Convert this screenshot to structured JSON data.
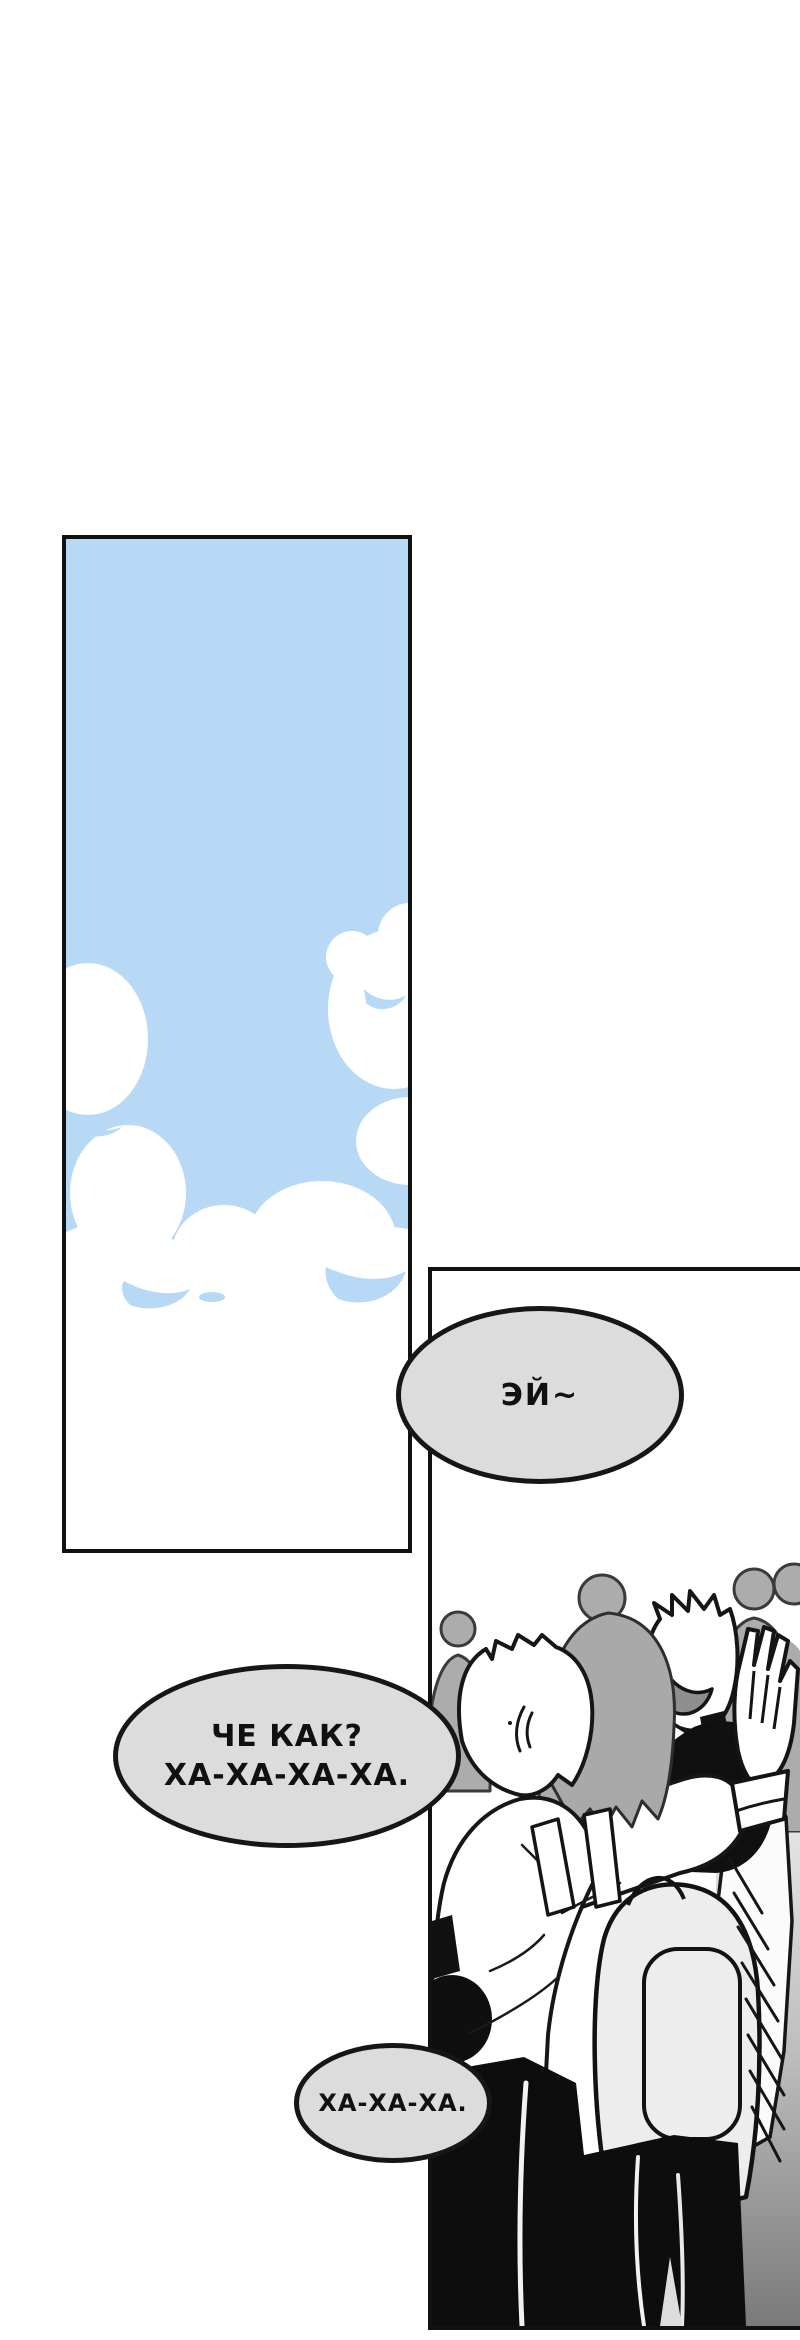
{
  "page": {
    "kind": "webtoon comic page",
    "language": "ru",
    "background": "#FFFFFF"
  },
  "colors": {
    "panel_border": "#111111",
    "sky_blue": "#B8D9F5",
    "cloud_white": "#FFFFFF",
    "bubble_fill": "#DCDCDC",
    "bubble_border": "#161616",
    "crowd_gray": "#ACACAC",
    "hair_gray": "#A9A9A9",
    "backpack_gray": "#EDEDED",
    "mouth_gray": "#8E8E8E",
    "wall_gray_top": "#EDEDED",
    "wall_gray_bottom": "#7A7A7A",
    "ink_black": "#111111",
    "pants_black": "#0D0D0D"
  },
  "panels": {
    "sky": {
      "description": "Tall panel of blue sky with large white cumulus clouds"
    },
    "scene": {
      "description": "Crowd of students; a laughing boy high-fives and hugs a friend wearing a backpack, gray silhouettes behind"
    }
  },
  "speech_bubbles": {
    "hey": {
      "text": "ЭЙ~"
    },
    "chekak": {
      "line1": "ЧЕ КАК?",
      "line2": "ХА-ХА-ХА-ХА."
    },
    "haha": {
      "text": "ХА-ХА-ХА."
    }
  }
}
